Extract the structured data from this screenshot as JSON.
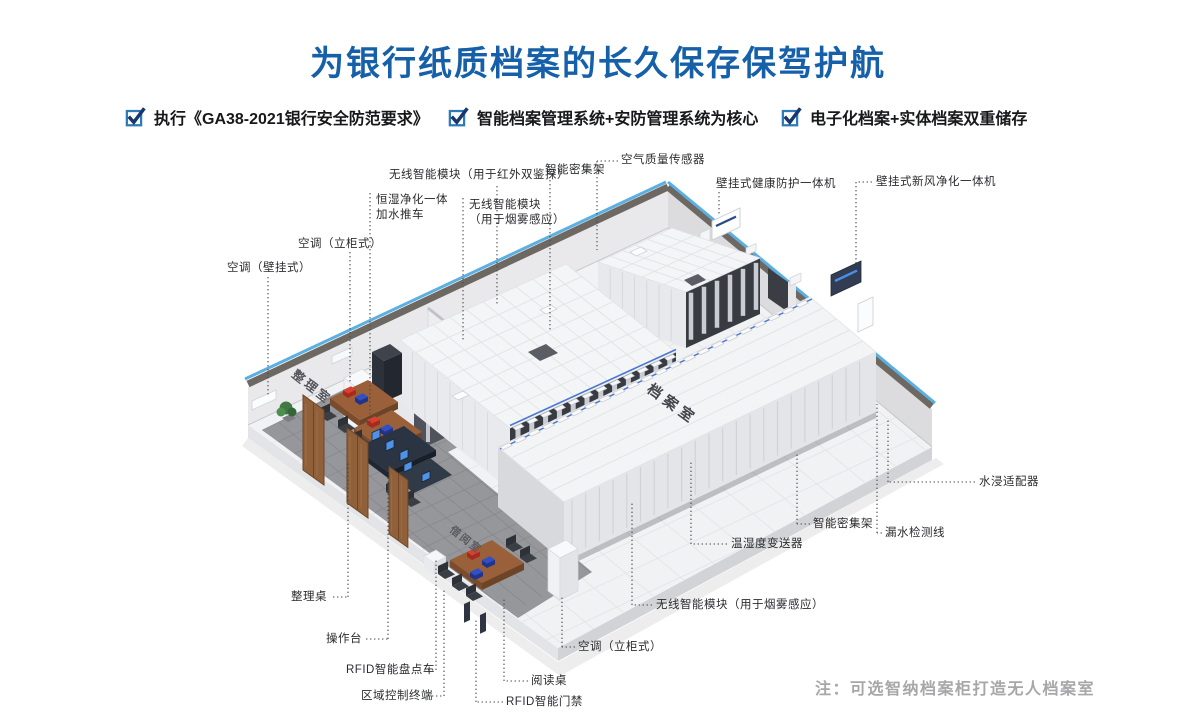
{
  "header": {
    "title": "为银行纸质档案的长久保存保驾护航"
  },
  "checks": {
    "items": [
      "执行《GA38-2021银行安全防范要求》",
      "智能档案管理系统+安防管理系统为核心",
      "电子化档案+实体档案双重储存"
    ]
  },
  "room": {
    "sorting_room_label": "整理室",
    "archive_room_label": "档案室",
    "reading_room_label": "借阅室"
  },
  "note": {
    "text": "注：可选智纳档案柜打造无人档案室"
  },
  "colors": {
    "title_blue": "#1660a9",
    "check_box_blue": "#2d7ab8",
    "check_mark_navy": "#16386e",
    "wall_trim_blue": "#5bb0e1",
    "leader_gray": "#47484c",
    "note_gray": "#a7a7a9",
    "red_box": "#d23a2c",
    "blue_box": "#3050c8"
  },
  "callouts": [
    {
      "name": "wireless-module-ir",
      "text": "无线智能模块（用于红外双鉴探）",
      "x": 389,
      "y": 168,
      "lines": [
        [
          497,
          186,
          497,
          305
        ]
      ]
    },
    {
      "name": "smart-dense-rack-top",
      "text": "智能密集架",
      "x": 545,
      "y": 163,
      "lines": [
        [
          550,
          180,
          550,
          330
        ]
      ]
    },
    {
      "name": "air-quality-sensor",
      "text": "空气质量传感器",
      "x": 621,
      "y": 153,
      "lines": [
        [
          618,
          161,
          597,
          161
        ],
        [
          597,
          161,
          597,
          250
        ]
      ]
    },
    {
      "name": "humidify-purify-cart",
      "text": "恒湿净化一体\n加水推车",
      "x": 376,
      "y": 193,
      "lines": [
        [
          370,
          193,
          370,
          424
        ]
      ]
    },
    {
      "name": "wireless-module-smoke-top",
      "text": "无线智能模块\n（用于烟雾感应）",
      "x": 469,
      "y": 198,
      "lines": [
        [
          463,
          198,
          463,
          340
        ]
      ]
    },
    {
      "name": "wall-health-unit",
      "text": "壁挂式健康防护一体机",
      "x": 716,
      "y": 177,
      "lines": [
        [
          719,
          192,
          719,
          216
        ]
      ]
    },
    {
      "name": "wall-freshair-unit",
      "text": "壁挂式新风净化一体机",
      "x": 876,
      "y": 175,
      "lines": [
        [
          872,
          182,
          856,
          182
        ],
        [
          856,
          182,
          856,
          266
        ]
      ]
    },
    {
      "name": "ac-cabinet-left",
      "text": "空调（立柜式）",
      "x": 298,
      "y": 237,
      "lines": [
        [
          350,
          252,
          350,
          382
        ]
      ]
    },
    {
      "name": "ac-wall-left",
      "text": "空调（壁挂式）",
      "x": 227,
      "y": 261,
      "lines": [
        [
          268,
          277,
          268,
          396
        ]
      ]
    },
    {
      "name": "sorting-desk",
      "text": "整理桌",
      "x": 291,
      "y": 590,
      "lines": [
        [
          333,
          597,
          348,
          597
        ],
        [
          348,
          597,
          348,
          462
        ]
      ]
    },
    {
      "name": "operation-console",
      "text": "操作台",
      "x": 326,
      "y": 632,
      "lines": [
        [
          366,
          639,
          388,
          639
        ],
        [
          388,
          639,
          388,
          476
        ]
      ]
    },
    {
      "name": "rfid-inventory-cart",
      "text": "RFID智能盘点车",
      "x": 346,
      "y": 663,
      "lines": [
        [
          424,
          670,
          436,
          670
        ],
        [
          436,
          670,
          436,
          560
        ]
      ]
    },
    {
      "name": "zone-control-terminal",
      "text": "区域控制终端",
      "x": 361,
      "y": 689,
      "lines": [
        [
          432,
          696,
          444,
          696
        ],
        [
          444,
          696,
          444,
          588
        ]
      ]
    },
    {
      "name": "reading-desk",
      "text": "阅读桌",
      "x": 531,
      "y": 674,
      "lines": [
        [
          528,
          681,
          504,
          681
        ],
        [
          504,
          681,
          504,
          598
        ]
      ]
    },
    {
      "name": "rfid-access-gate",
      "text": "RFID智能门禁",
      "x": 506,
      "y": 695,
      "lines": [
        [
          503,
          702,
          476,
          702
        ],
        [
          476,
          702,
          476,
          618
        ]
      ]
    },
    {
      "name": "ac-cabinet-bottom",
      "text": "空调（立柜式）",
      "x": 578,
      "y": 640,
      "lines": [
        [
          575,
          647,
          562,
          647
        ],
        [
          562,
          647,
          562,
          596
        ]
      ]
    },
    {
      "name": "wireless-module-smoke-bottom",
      "text": "无线智能模块（用于烟雾感应）",
      "x": 656,
      "y": 598,
      "lines": [
        [
          652,
          605,
          632,
          605
        ],
        [
          632,
          605,
          632,
          502
        ]
      ]
    },
    {
      "name": "temp-humidity-transmitter",
      "text": "温湿度变送器",
      "x": 731,
      "y": 537,
      "lines": [
        [
          727,
          544,
          691,
          544
        ],
        [
          691,
          544,
          691,
          460
        ]
      ]
    },
    {
      "name": "smart-dense-rack-right",
      "text": "智能密集架",
      "x": 813,
      "y": 517,
      "lines": [
        [
          810,
          524,
          797,
          524
        ],
        [
          797,
          524,
          797,
          452
        ]
      ]
    },
    {
      "name": "leak-detection-line",
      "text": "漏水检测线",
      "x": 885,
      "y": 526,
      "lines": [
        [
          882,
          533,
          877,
          533
        ],
        [
          877,
          533,
          877,
          404
        ]
      ]
    },
    {
      "name": "water-immersion-adapter",
      "text": "水浸适配器",
      "x": 979,
      "y": 475,
      "lines": [
        [
          975,
          482,
          888,
          482
        ],
        [
          888,
          482,
          888,
          418
        ]
      ]
    }
  ]
}
